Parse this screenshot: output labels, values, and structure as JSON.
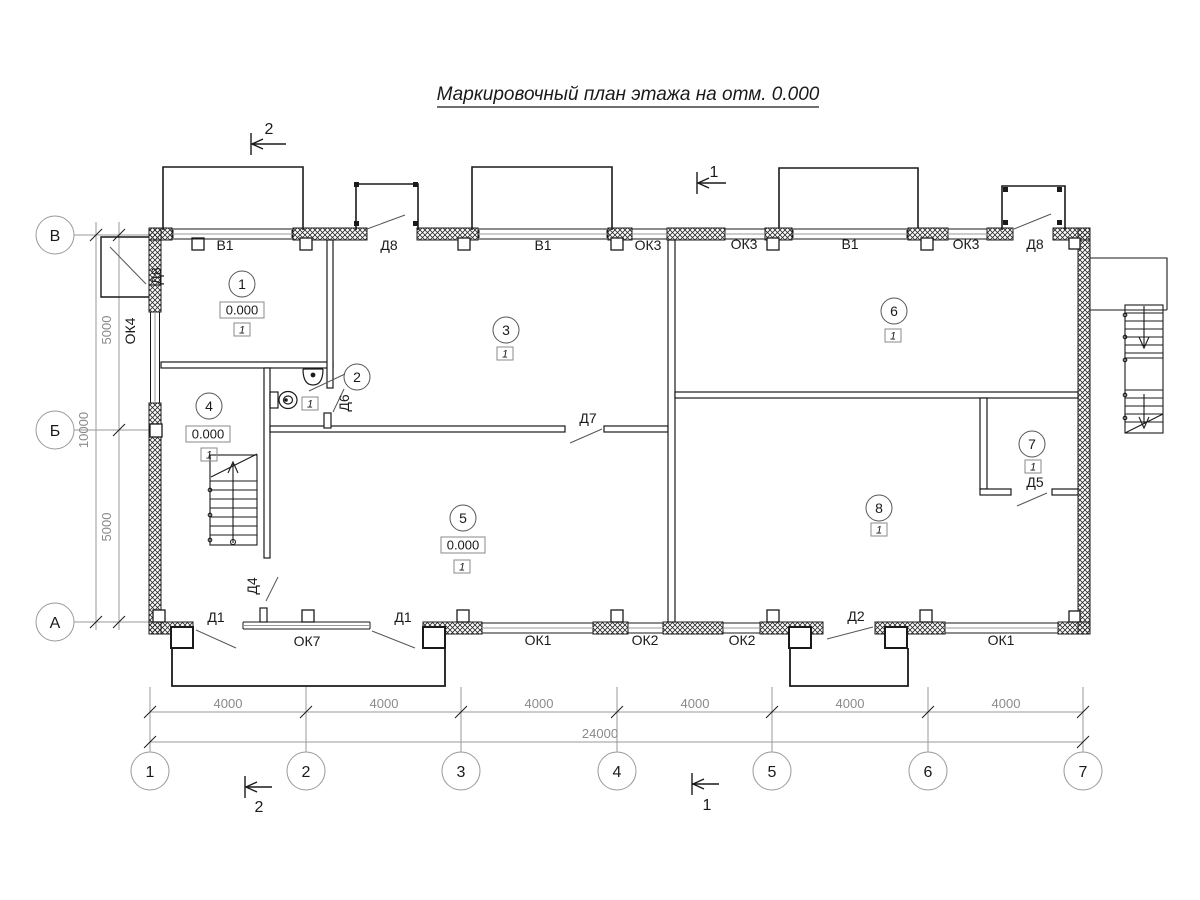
{
  "title": "Маркировочный план этажа на отм. 0.000",
  "axes": {
    "bottom": [
      "1",
      "2",
      "3",
      "4",
      "5",
      "6",
      "7"
    ],
    "left": [
      "В",
      "Б",
      "А"
    ]
  },
  "dimensions": {
    "bottom_segments": [
      "4000",
      "4000",
      "4000",
      "4000",
      "4000",
      "4000"
    ],
    "bottom_total": "24000",
    "left_upper": "5000",
    "left_total": "10000",
    "left_lower": "5000"
  },
  "section_marks": {
    "mark1": "1",
    "mark2": "2"
  },
  "rooms": [
    {
      "number": "1",
      "elevation": "0.000",
      "type": "1"
    },
    {
      "number": "2",
      "type": "1"
    },
    {
      "number": "3",
      "type": "1"
    },
    {
      "number": "4",
      "elevation": "0.000",
      "type": "1"
    },
    {
      "number": "5",
      "elevation": "0.000",
      "type": "1"
    },
    {
      "number": "6",
      "type": "1"
    },
    {
      "number": "7",
      "type": "1"
    },
    {
      "number": "8",
      "type": "1"
    }
  ],
  "openings": {
    "top": [
      "В1",
      "Д8",
      "В1",
      "ОК3",
      "ОК3",
      "В1",
      "ОК3",
      "Д8"
    ],
    "bottom": [
      "Д1",
      "ОК7",
      "Д1",
      "ОК1",
      "ОК2",
      "ОК2",
      "Д2",
      "ОК1"
    ],
    "left": [
      "Д8",
      "ОК4"
    ],
    "interior": [
      "Д4",
      "Д5",
      "Д6",
      "Д7"
    ]
  }
}
